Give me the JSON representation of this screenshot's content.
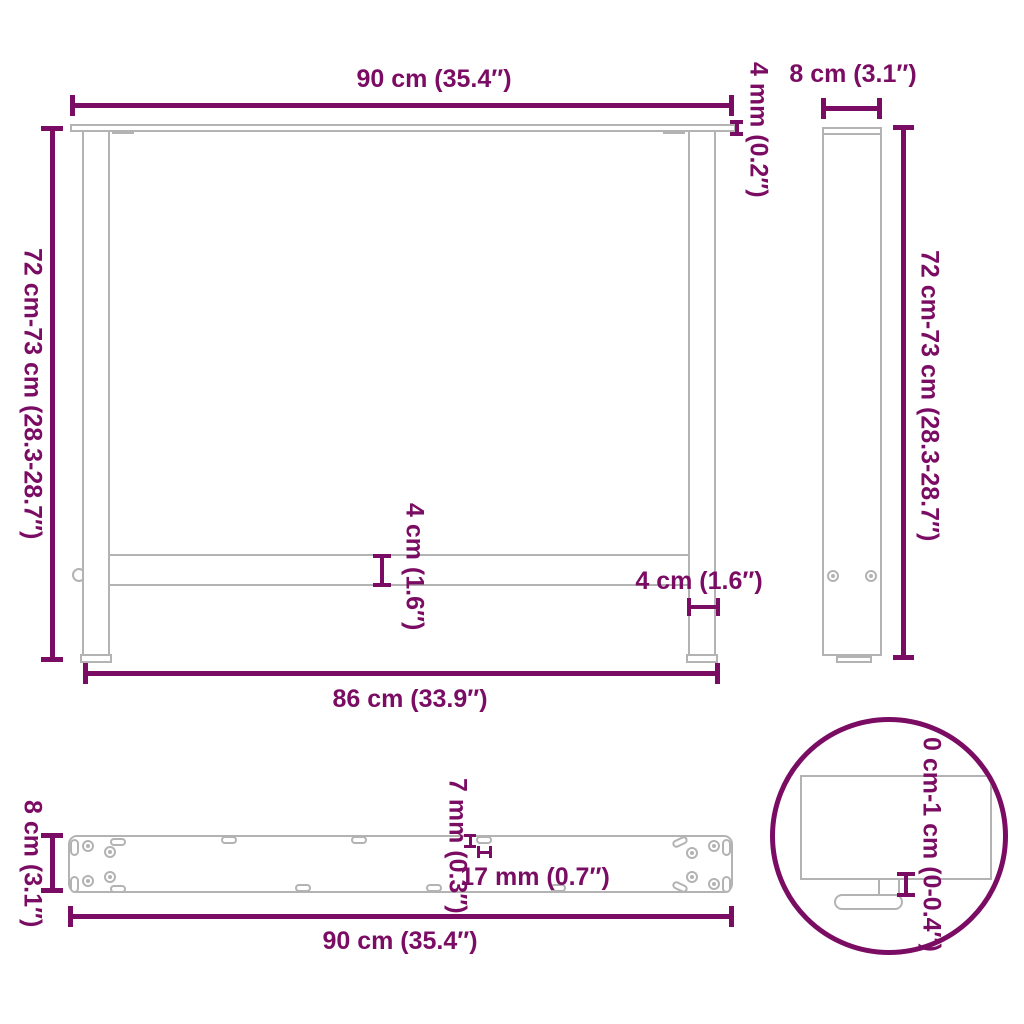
{
  "colors": {
    "dimension": "#7B0C63",
    "drawing": "#B3B3B3",
    "background": "#FFFFFF"
  },
  "labels": {
    "front_width_top": "90 cm (35.4″)",
    "plate_thickness": "4 mm (0.2″)",
    "front_height": "72 cm-73 cm (28.3-28.7″)",
    "crossbar_width": "4 cm (1.6″)",
    "leg_width": "4 cm (1.6″)",
    "front_width_bottom": "86 cm (33.9″)",
    "side_depth": "8 cm (3.1″)",
    "side_height": "72 cm-73 cm (28.3-28.7″)",
    "plate_depth": "8 cm (3.1″)",
    "hole_width": "7 mm (0.3″)",
    "hole_length": "17 mm (0.7″)",
    "plate_length": "90 cm (35.4″)",
    "foot_adjustment": "0 cm-1 cm (0-0.4″)"
  }
}
